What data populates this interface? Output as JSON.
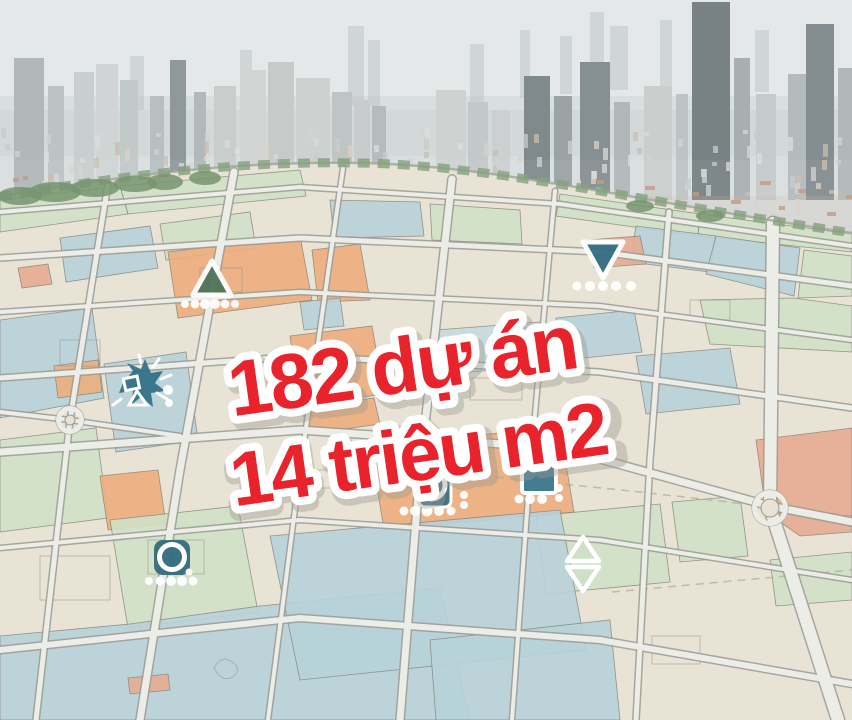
{
  "page": {
    "title": "Aerial masterplan graphic: city skyline over zoning map"
  },
  "headline": {
    "line1": "182 dự án",
    "line2": "14 triệu m2",
    "text_color": "#e8232b",
    "outline_color": "#ffffff"
  },
  "skyline": {
    "haze_top": "#e4e8e9",
    "haze_bottom": "#d3d9da"
  },
  "map": {
    "palette": {
      "base": "#e7e2d2",
      "green": "#cde0c3",
      "blue": "#b5cfd8",
      "bluelt": "#c4d8de",
      "orange": "#ecaa78",
      "salmon": "#e5a78d",
      "road": "#edece6",
      "road_casing": "#97968f",
      "line": "#7a7a72",
      "boundary_trees": "#7e9c77"
    },
    "markers": [
      {
        "name": "marker-triangle-up",
        "type": "triangle-up",
        "x": 212,
        "y": 281,
        "color": "#4f7458",
        "dots": [
          [
            -27,
            23,
            4
          ],
          [
            -17,
            23,
            4.5
          ],
          [
            -7,
            23,
            5
          ],
          [
            3,
            23,
            5
          ],
          [
            13,
            23,
            4.5
          ],
          [
            23,
            23,
            4
          ]
        ]
      },
      {
        "name": "marker-burst",
        "type": "burst",
        "x": 143,
        "y": 385,
        "color": "#2f6f85",
        "dots": [
          [
            25,
            5,
            5
          ],
          [
            26,
            18,
            4
          ]
        ]
      },
      {
        "name": "marker-triangle-down",
        "type": "triangle-down",
        "x": 603,
        "y": 256,
        "color": "#336d84",
        "dots": [
          [
            -26,
            30,
            4.5
          ],
          [
            -13,
            30,
            5
          ],
          [
            0,
            30,
            5
          ],
          [
            13,
            30,
            5
          ],
          [
            28,
            30,
            5
          ]
        ]
      },
      {
        "name": "marker-circle-square",
        "type": "circle-square",
        "x": 433,
        "y": 489,
        "color": "#3f7183",
        "dots": [
          [
            -29,
            22,
            4.5
          ],
          [
            -18,
            22,
            5
          ],
          [
            -6,
            22,
            5.5
          ],
          [
            6,
            22,
            5
          ],
          [
            18,
            22,
            4.5
          ],
          [
            31,
            6,
            4
          ],
          [
            31,
            16,
            4
          ]
        ]
      },
      {
        "name": "marker-square",
        "type": "square",
        "x": 539,
        "y": 476,
        "color": "#447c92",
        "dots": [
          [
            -20,
            23,
            4.5
          ],
          [
            -9,
            23,
            5
          ],
          [
            3,
            23,
            5
          ],
          [
            20,
            12,
            4
          ],
          [
            20,
            22,
            4
          ]
        ]
      },
      {
        "name": "marker-ring-square",
        "type": "ring-square",
        "x": 172,
        "y": 557,
        "color": "#336b7e",
        "dots": [
          [
            -23,
            24,
            4
          ],
          [
            -12,
            24,
            4.5
          ],
          [
            -1,
            24,
            5
          ],
          [
            10,
            24,
            5
          ],
          [
            21,
            24,
            4.5
          ],
          [
            17,
            15,
            3.5
          ]
        ]
      },
      {
        "name": "marker-double-triangle",
        "type": "double-triangle",
        "x": 583,
        "y": 564,
        "color": "#b8cdb4",
        "dots": []
      }
    ]
  }
}
